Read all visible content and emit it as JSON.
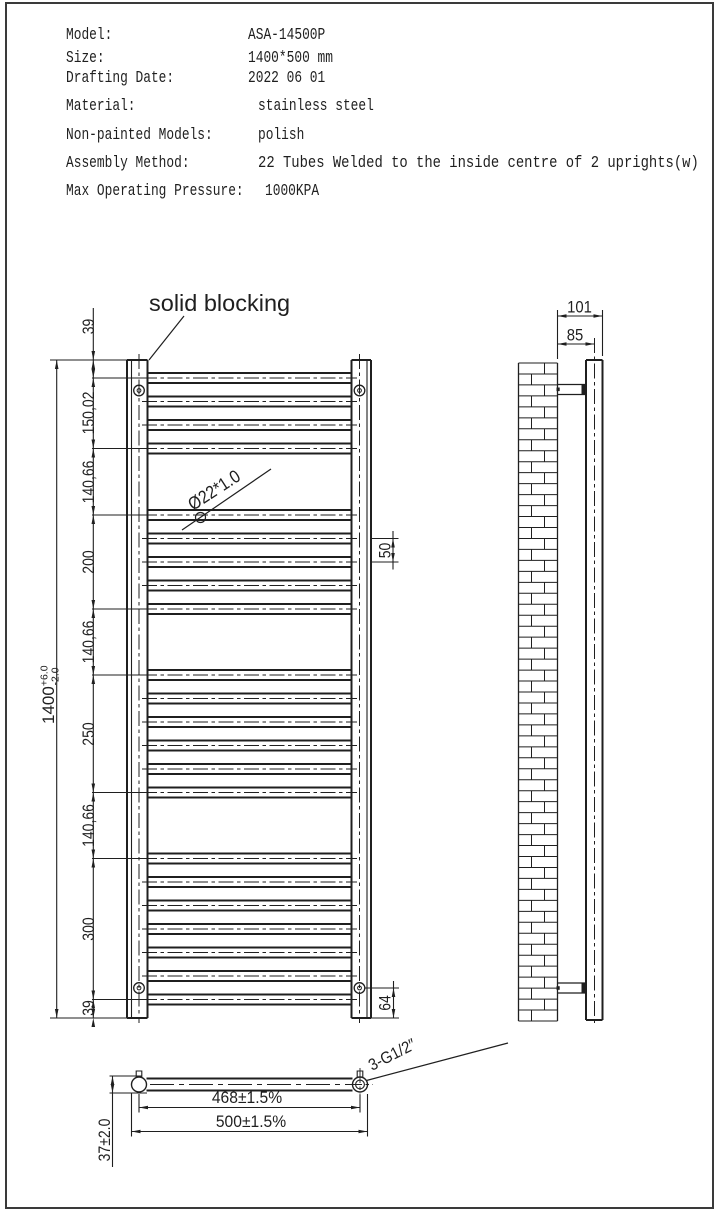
{
  "sheet": {
    "line_color": "#1f1f1f"
  },
  "spec_table": {
    "rows": [
      {
        "label": "Model:",
        "value": "ASA-14500P"
      },
      {
        "label": "Size:",
        "value": "1400*500 mm"
      },
      {
        "label": "Drafting Date:",
        "value": "2022 06 01"
      },
      {
        "label": "Material:",
        "value": "stainless steel"
      },
      {
        "label": "Non-painted Models:",
        "value": "polish"
      },
      {
        "label": "Assembly Method:",
        "value": "22 Tubes Welded to the inside centre of 2 uprights(w)"
      },
      {
        "label": "Max Operating Pressure:",
        "value": "1000KPA"
      }
    ]
  },
  "front_view": {
    "blocking_callout": "solid blocking",
    "tube_callout": "Ø22*1.0",
    "overall_height": {
      "value": "1400",
      "tol_plus": "+6.0",
      "tol_minus": "-2.0"
    },
    "chain_dims": [
      "39",
      "150,02",
      "140,66",
      "200",
      "140,66",
      "250",
      "140,66",
      "300",
      "39"
    ],
    "tube_pitch": "50",
    "bracket_offset": "64"
  },
  "side_view": {
    "overall_depth": "101",
    "wall_to_center": "85"
  },
  "bottom_view": {
    "tapping_centers": "468±1.5%",
    "overall_width": "500±1.5%",
    "depth": "37±2.0",
    "thread_callout": "3-G1/2″"
  }
}
